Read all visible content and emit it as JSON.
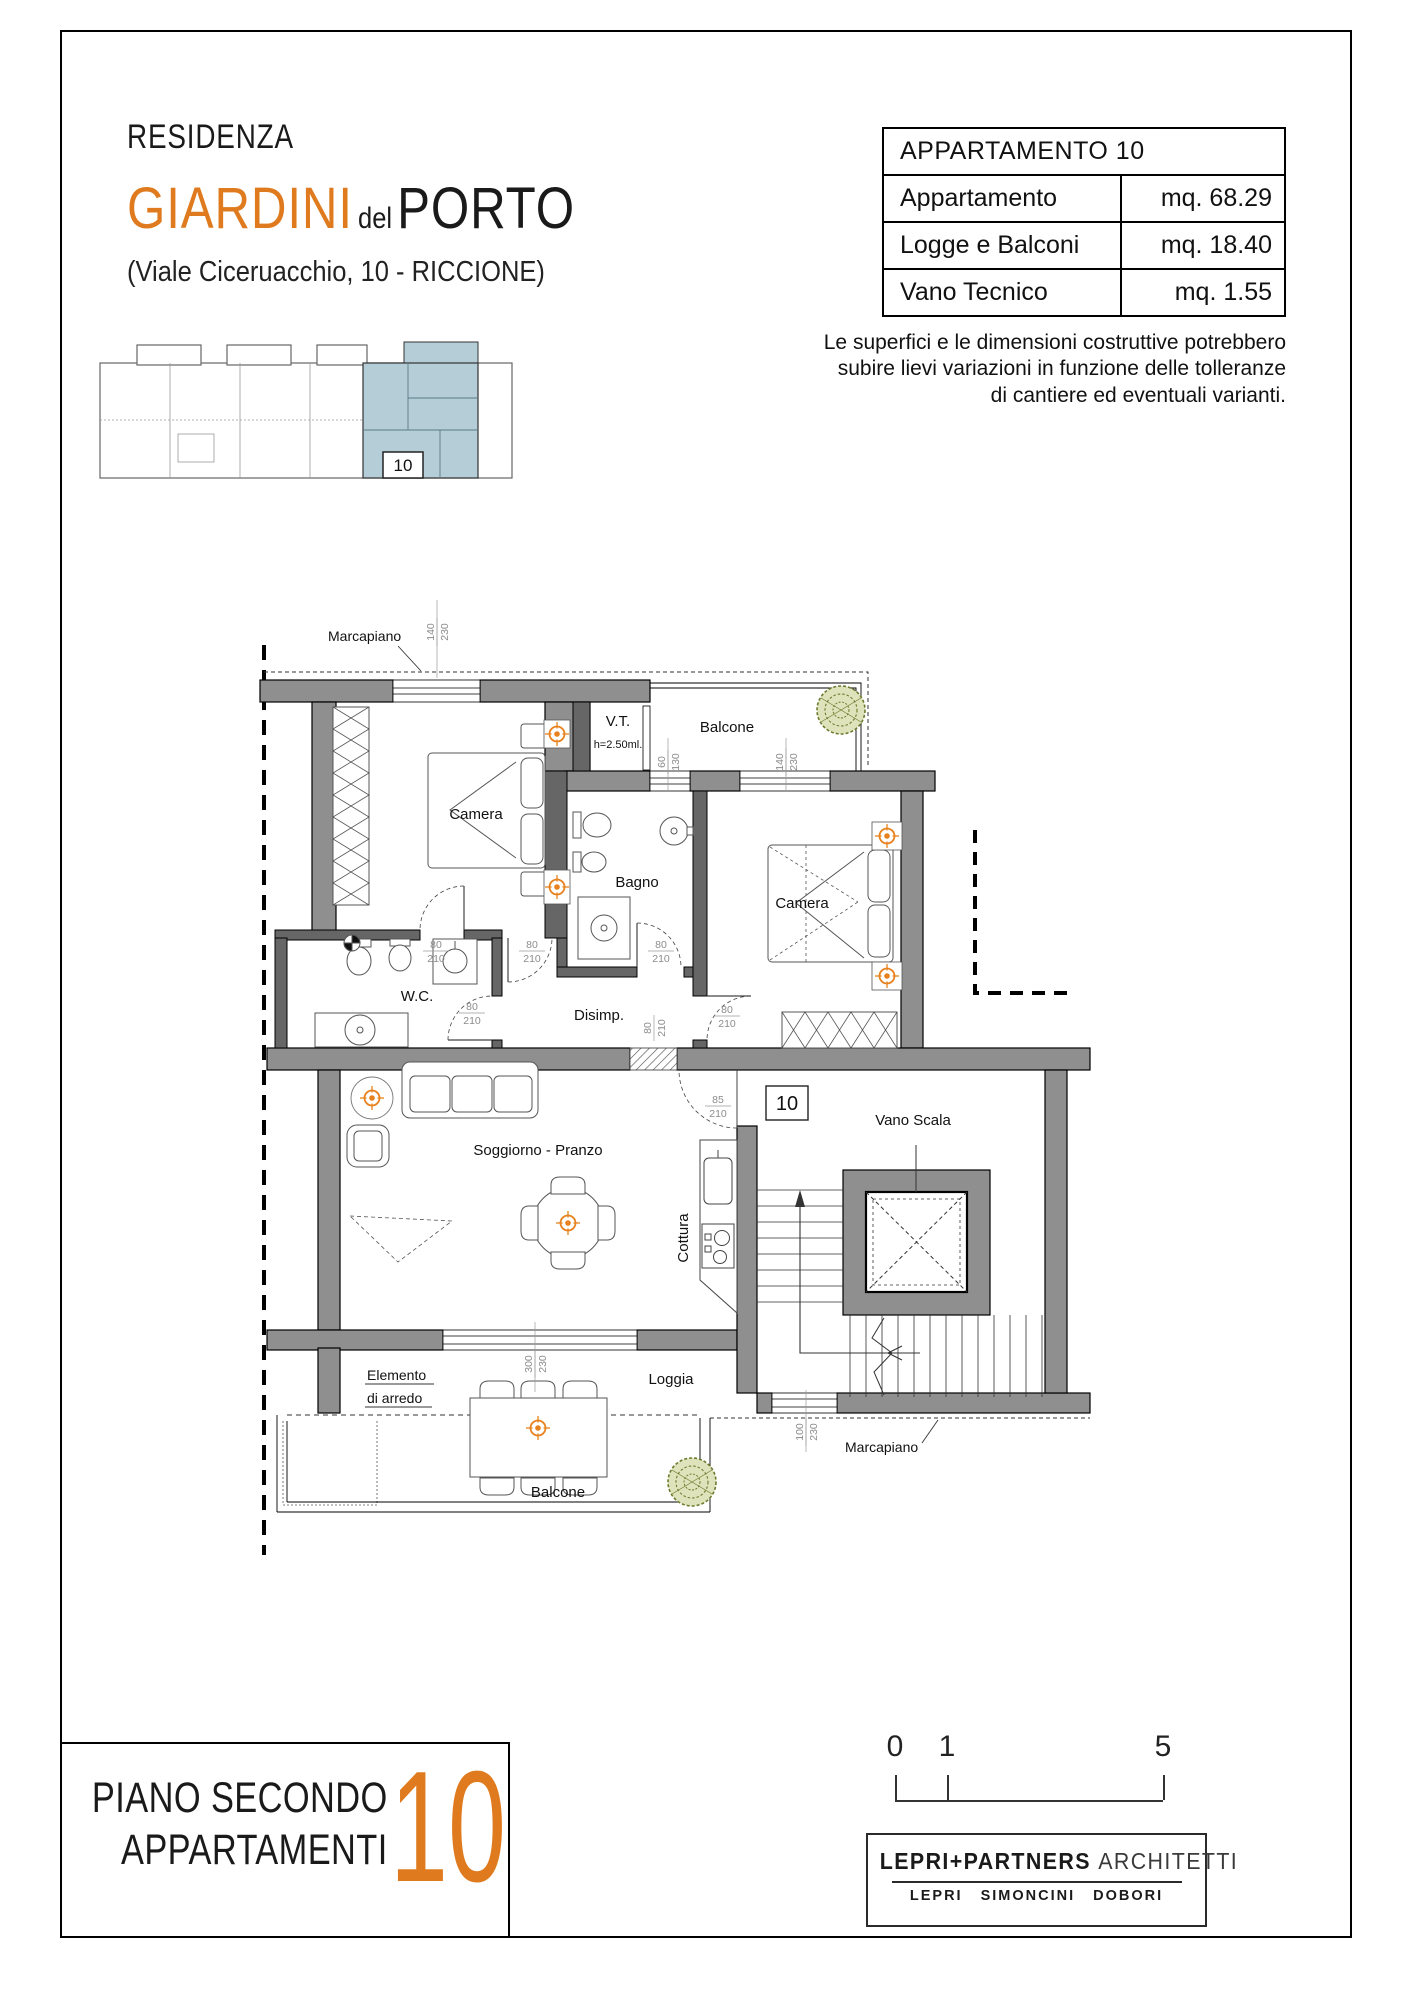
{
  "header": {
    "residenza": "RESIDENZA",
    "title_orange": "GIARDINI",
    "title_del": "del",
    "title_black": "PORTO",
    "address": "(Viale Ciceruacchio, 10 - RICCIONE)"
  },
  "info_table": {
    "title": "APPARTAMENTO 10",
    "rows": [
      {
        "label": "Appartamento",
        "value": "mq. 68.29"
      },
      {
        "label": "Logge e Balconi",
        "value": "mq. 18.40"
      },
      {
        "label": "Vano Tecnico",
        "value": "mq. 1.55"
      }
    ],
    "disclaimer_lines": [
      "Le superfici e le dimensioni costruttive potrebbero",
      "subire lievi variazioni in funzione delle tolleranze",
      "di cantiere ed eventuali varianti."
    ]
  },
  "key_plan": {
    "unit": "10"
  },
  "plan": {
    "labels": {
      "marcapiano_top": "Marcapiano",
      "marcapiano_bottom": "Marcapiano",
      "vt": "V.T.",
      "vt_h": "h=2.50ml.",
      "balcone_top": "Balcone",
      "camera_left": "Camera",
      "camera_right": "Camera",
      "bagno": "Bagno",
      "wc": "W.C.",
      "disimp": "Disimp.",
      "soggiorno": "Soggiorno - Pranzo",
      "cottura": "Cottura",
      "vano_scala": "Vano Scala",
      "loggia": "Loggia",
      "elemento_1": "Elemento",
      "elemento_2": "di arredo",
      "balcone_bottom": "Balcone",
      "unit_badge": "10"
    },
    "dims": {
      "d60": "60",
      "d80": "80",
      "d85": "85",
      "d100": "100",
      "d130": "130",
      "d140": "140",
      "d210": "210",
      "d230": "230",
      "d300": "300"
    }
  },
  "footer": {
    "floor_line1": "PIANO SECONDO",
    "floor_line2": "APPARTAMENTI",
    "unit": "10",
    "scale_ticks": [
      "0",
      "1",
      "5"
    ],
    "firm_bold": "LEPRI+PARTNERS",
    "firm_light": "ARCHITETTI",
    "partners": [
      "LEPRI",
      "SIMONCINI",
      "DOBORI"
    ]
  },
  "colors": {
    "accent_orange": "#df7b1e",
    "highlight_blue": "#b5cdd7",
    "wall_gray": "#8f8f8f",
    "plant_green": "#6b7a2d",
    "dim_gray": "#8c8c8c",
    "target_orange": "#e8821e"
  }
}
